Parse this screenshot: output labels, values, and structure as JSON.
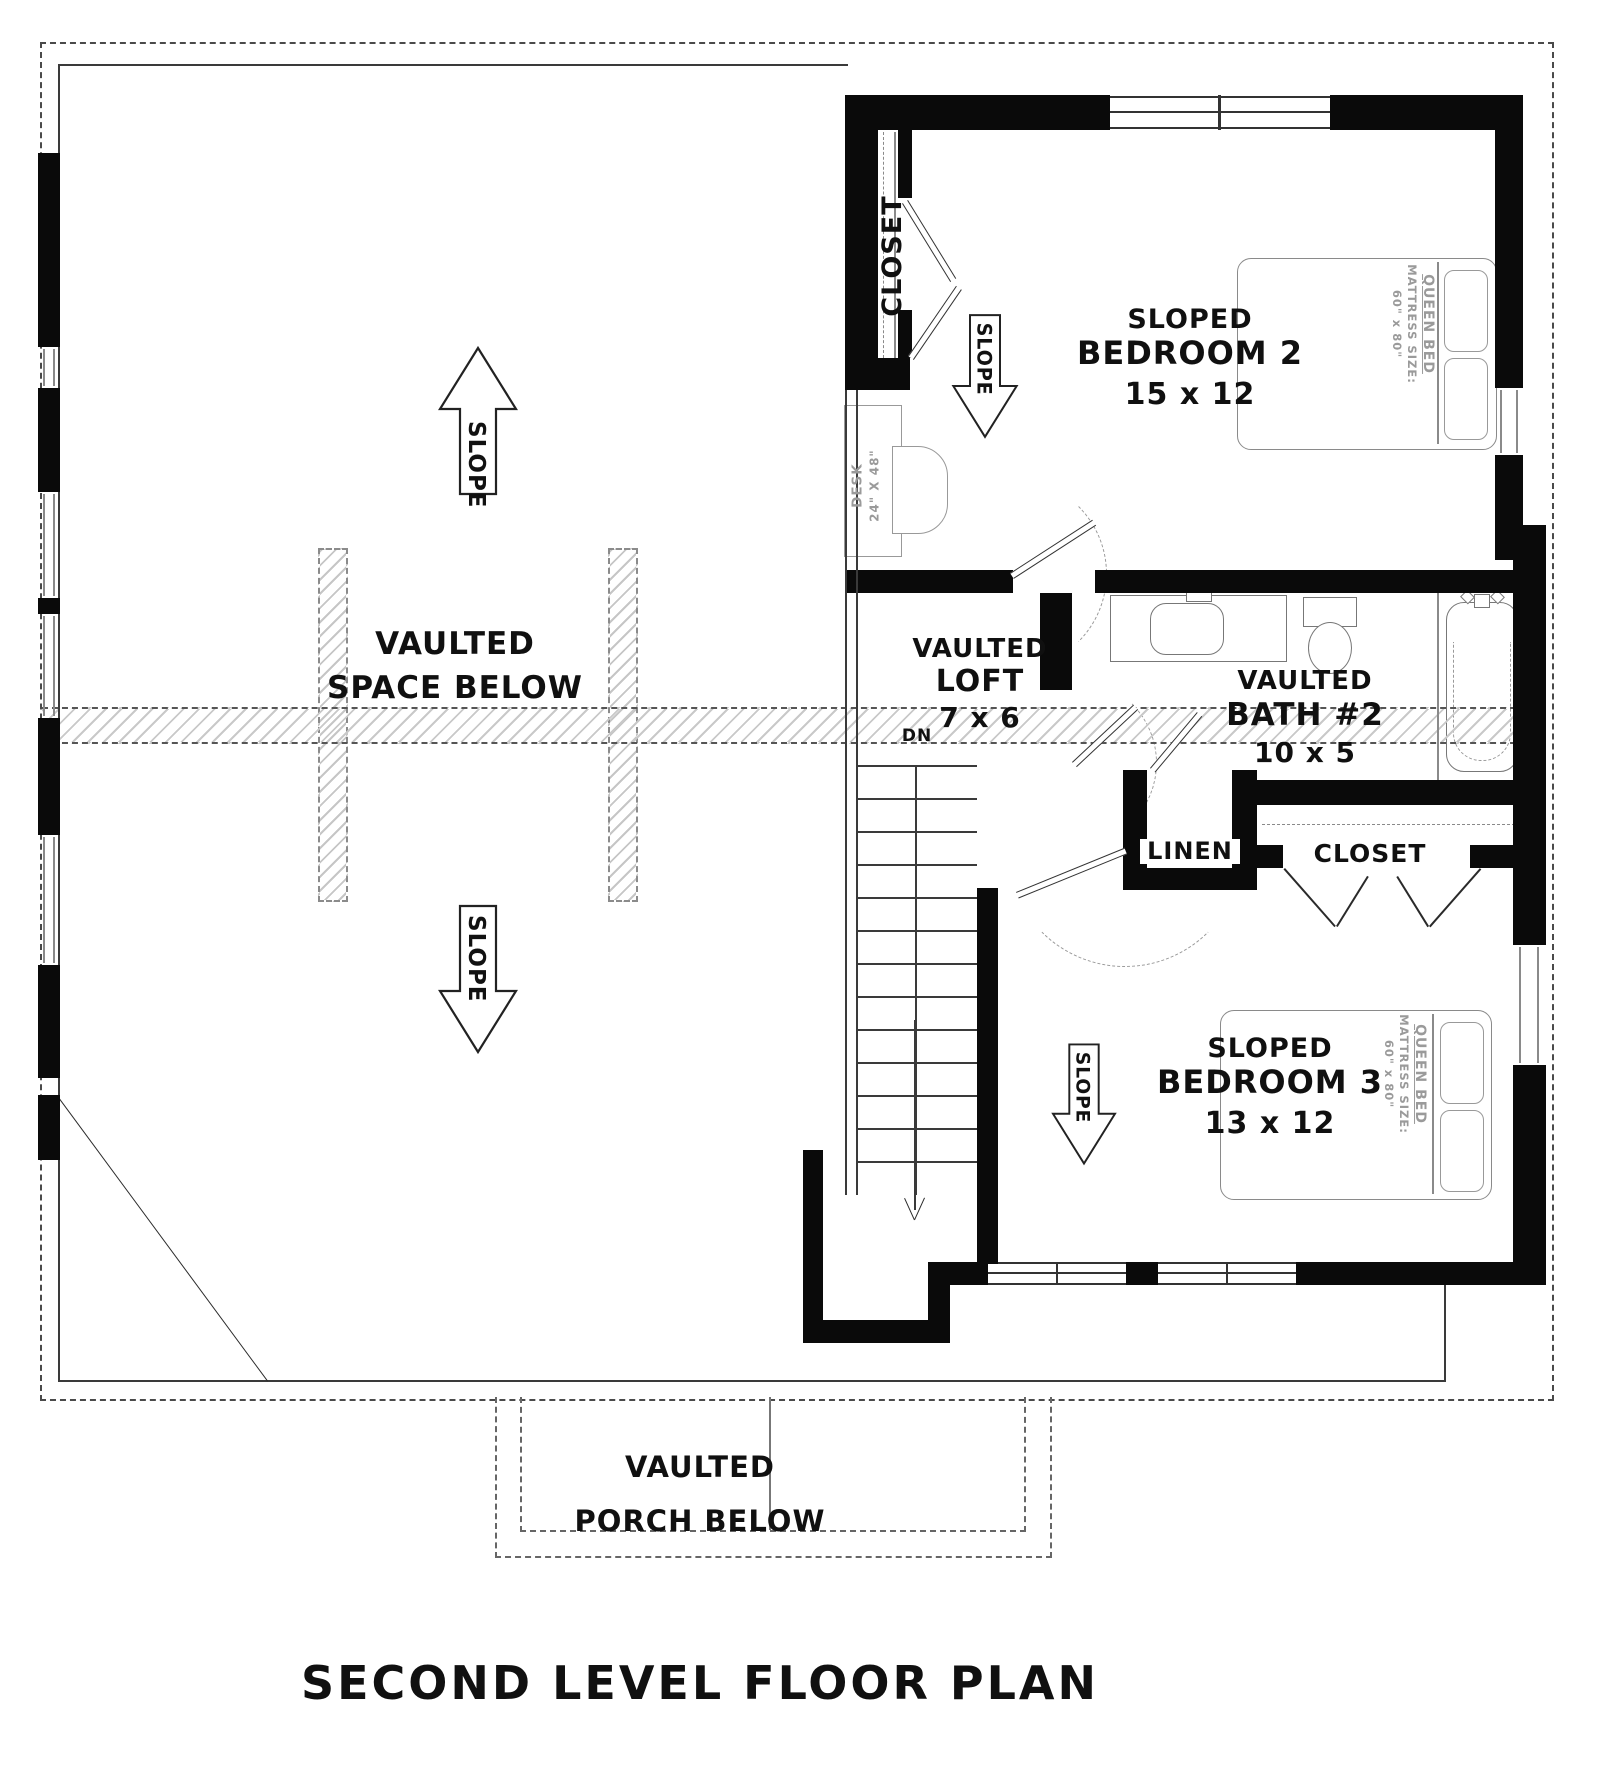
{
  "title": "SECOND LEVEL FLOOR PLAN",
  "colors": {
    "wall": "#0a0a0a",
    "thin_line": "#3a3a3a",
    "furniture": "#7d7d7d",
    "hatch": "#c6c6c6",
    "dashed": "#555555"
  },
  "open_area": {
    "l1": "VAULTED",
    "l2": "SPACE BELOW"
  },
  "slope_label": "SLOPE",
  "loft": {
    "l1": "VAULTED",
    "l2": "LOFT",
    "l3": "7 x 6",
    "dn": "DN"
  },
  "bath": {
    "l1": "VAULTED",
    "l2": "BATH #2",
    "l3": "10 x 5"
  },
  "bedroom2": {
    "l1": "SLOPED",
    "l2": "BEDROOM 2",
    "l3": "15 x 12"
  },
  "bedroom3": {
    "l1": "SLOPED",
    "l2": "BEDROOM 3",
    "l3": "13 x 12"
  },
  "closet_label": "CLOSET",
  "linen_label": "LINEN",
  "desk": {
    "l1": "DESK",
    "l2": "24\" X 48\""
  },
  "bed": {
    "l1": "QUEEN BED",
    "l2": "MATTRESS SIZE:",
    "l3": "60\" x 80\""
  },
  "porch": {
    "l1": "VAULTED",
    "l2": "PORCH BELOW"
  }
}
